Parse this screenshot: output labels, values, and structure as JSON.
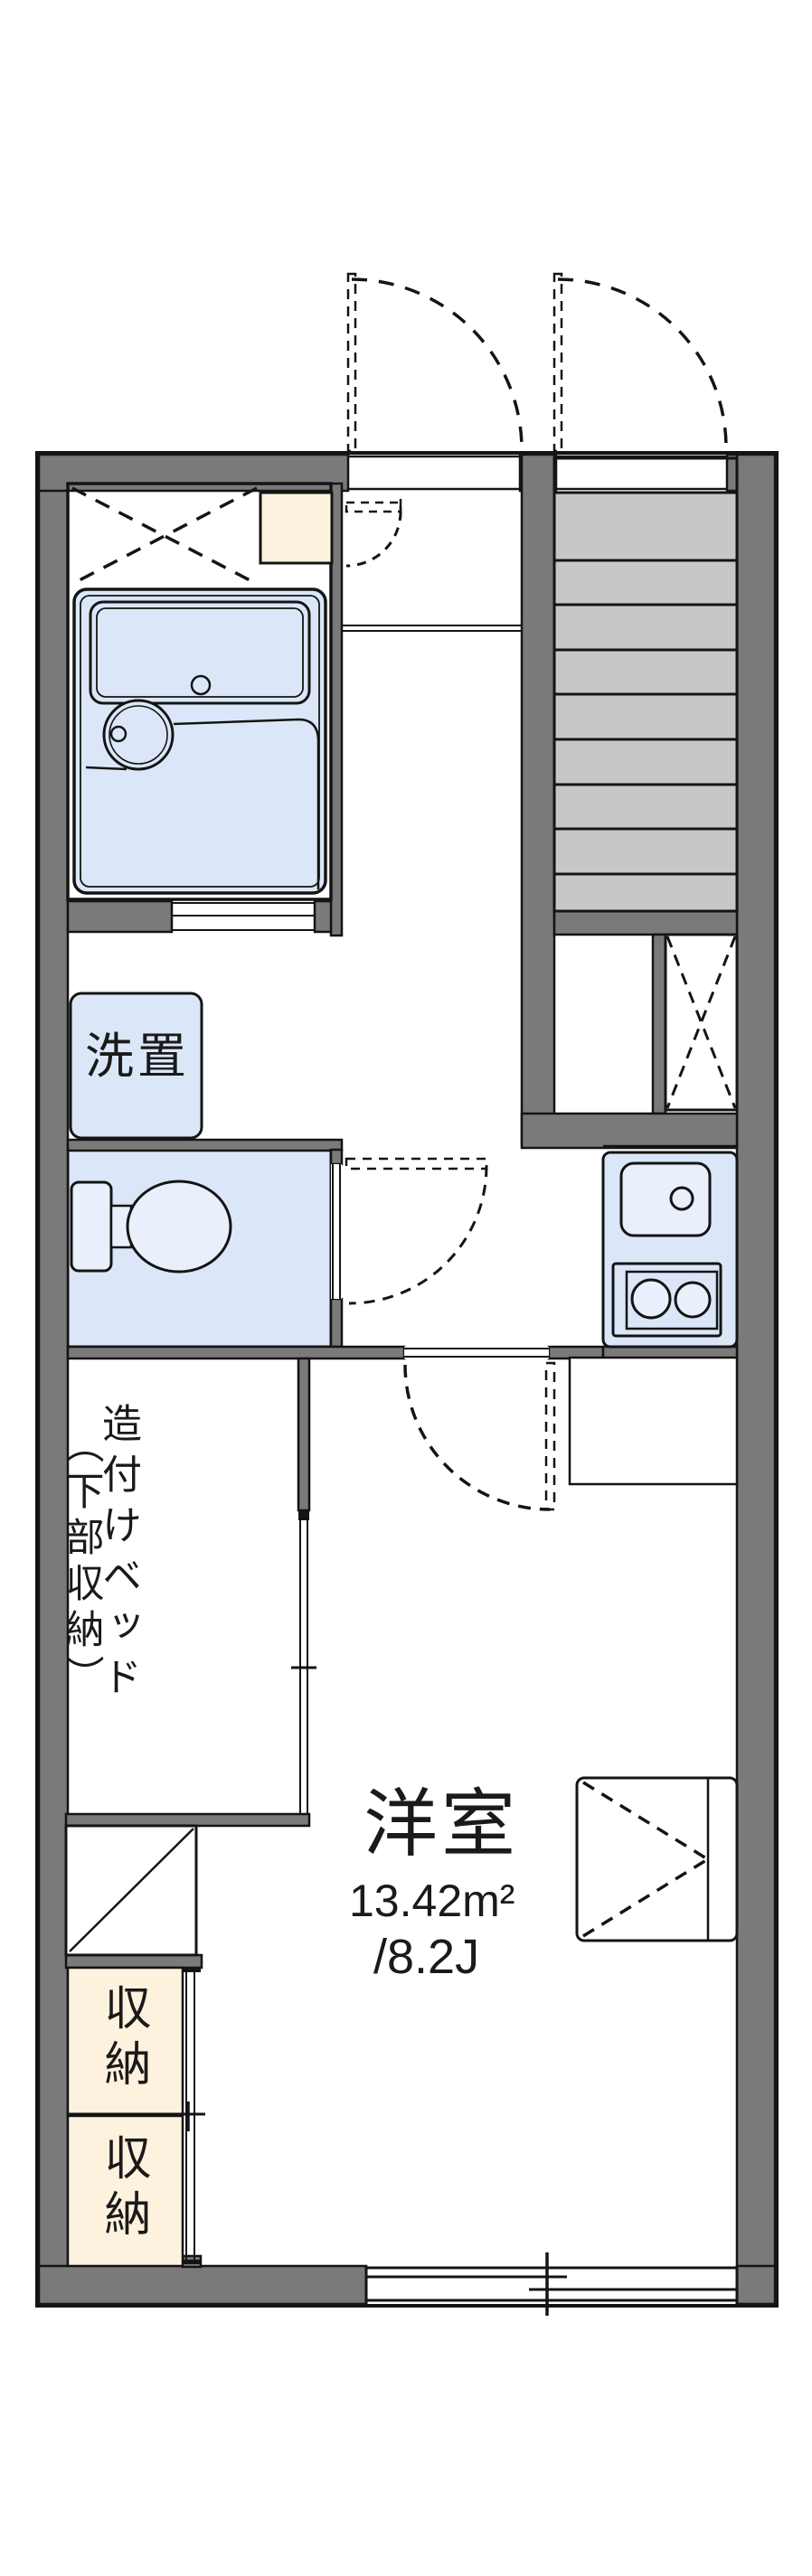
{
  "plan": {
    "type": "apartment-floor-plan",
    "rooms": {
      "washer": {
        "label": "洗置"
      },
      "bed": {
        "col_right": "造付けベッド",
        "col_left": "（下部収納）"
      },
      "storage_upper": {
        "label": "収納"
      },
      "storage_lower": {
        "label": "収納"
      },
      "main": {
        "name": "洋室",
        "area_m2": "13.42m²",
        "area_jo": "/8.2J"
      }
    },
    "colors": {
      "wall_gray": "#7a7a7a",
      "stair_tread_gray": "#c7c7c7",
      "fixture_blue": "#dbe7f8",
      "fixture_blue_light": "#e9f0fb",
      "storage_cream": "#fdf2de",
      "line_black": "#141414"
    }
  }
}
